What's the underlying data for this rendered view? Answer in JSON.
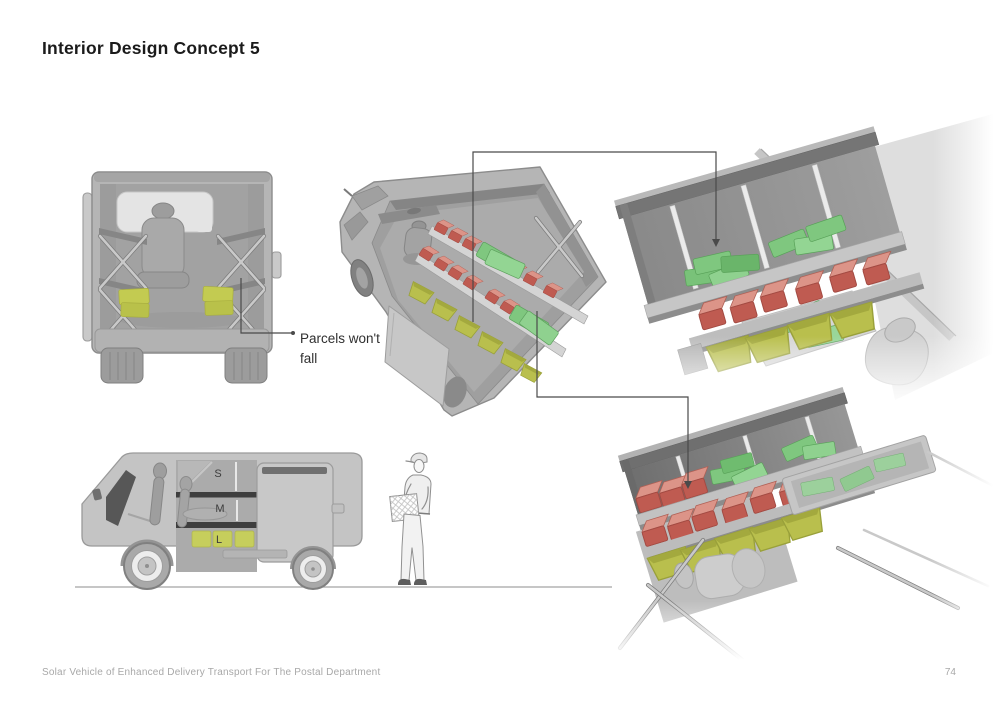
{
  "page": {
    "title": "Interior Design Concept 5",
    "footer_text": "Solar Vehicle of Enhanced Delivery Transport For The Postal Department",
    "page_number": "74"
  },
  "annotations": {
    "parcel_note_line1": "Parcels won't",
    "parcel_note_line2": "fall",
    "size_small": "S",
    "size_medium": "M",
    "size_large": "L"
  },
  "colors": {
    "parcel_green": "#7fc77f",
    "box_red": "#bf5b51",
    "bin_yellow": "#b9bf4d",
    "vehicle_gray": "#b5b5b5",
    "callout_line": "#4a4a4a",
    "title_text": "#1b1b1b",
    "footer_gray": "#a8a8a8"
  }
}
